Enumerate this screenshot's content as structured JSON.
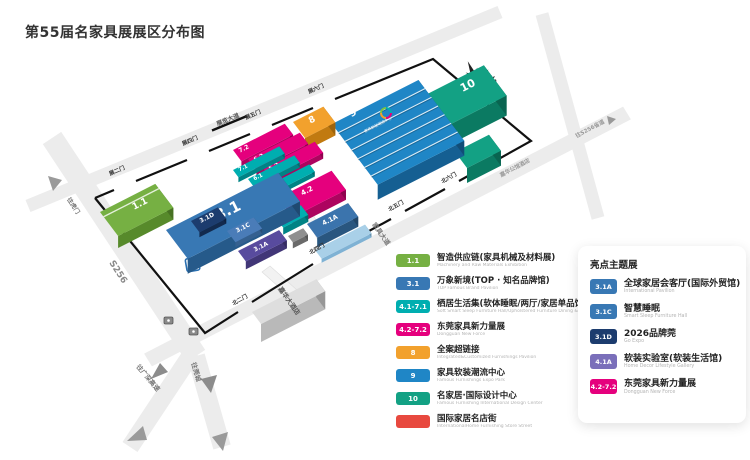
{
  "title": "第55届名家具展展区分布图",
  "legend": {
    "items": [
      {
        "badge": "1.1",
        "color": "#76b043",
        "title": "智造供应链(家具机械及材料展)",
        "subtitle": "Machinery and Raw Materials Exhibition"
      },
      {
        "badge": "3.1",
        "color": "#3878b4",
        "title": "万象新境(TOP · 知名品牌馆)",
        "subtitle": "TOP Famous Brand Pavilion"
      },
      {
        "badge": "4.1-7.1",
        "color": "#00aeb0",
        "title": "栖居生活集(软体睡眠/两厅/家居单品馆)",
        "subtitle": "Soft Smart Sleep Furniture Hall/Upholstered Furniture Dining & Living Furniture Hall"
      },
      {
        "badge": "4.2-7.2",
        "color": "#e5007d",
        "title": "东莞家具新力量展",
        "subtitle": "Dongguan New Force"
      },
      {
        "badge": "8",
        "color": "#f2a12d",
        "title": "全案超链接",
        "subtitle": "Integrated&Customized Furnishings Pavilion"
      },
      {
        "badge": "9",
        "color": "#1f86c6",
        "title": "家具软装潮流中心",
        "subtitle": "Famous Furnishings Expo Park"
      },
      {
        "badge": "10",
        "color": "#13a184",
        "title": "名家居·国际设计中心",
        "subtitle": "Famous Furnishing International Design Center"
      },
      {
        "badge": "",
        "color": "#e8493f",
        "title": "国际家居名店街",
        "subtitle": "InternationalHome Furnishing Store Street"
      }
    ]
  },
  "panel": {
    "header": "亮点主题展",
    "items": [
      {
        "badge": "3.1A",
        "color": "#3878b4",
        "title": "全球家居会客厅(国际外贸馆)",
        "subtitle": "International Pavilion"
      },
      {
        "badge": "3.1C",
        "color": "#3878b4",
        "title": "智慧睡眠",
        "subtitle": "Smart Sleep Furniture Hall"
      },
      {
        "badge": "3.1D",
        "color": "#1c3c6e",
        "title": "2026品牌莞",
        "subtitle": "Go Expo"
      },
      {
        "badge": "4.1A",
        "color": "#7a6fba",
        "title": "软装实验室(软装生活馆)",
        "subtitle": "Home Decor Lifestyle Gallery"
      },
      {
        "badge": "4.2-7.2",
        "color": "#e5007d",
        "title": "东莞家具新力量展",
        "subtitle": "Dongguan New Force"
      }
    ]
  },
  "map": {
    "compass_label": "北",
    "parking_label": "P",
    "halls": [
      {
        "id": "hall-10",
        "t": "10",
        "x": 392,
        "y": 112,
        "a": 103,
        "b": 38,
        "h": 20,
        "c": "#13a184",
        "s": "#0b7a62",
        "tx": 468,
        "ty": 86,
        "ts": 11
      },
      {
        "id": "hall-10-wing",
        "t": "",
        "x": 455,
        "y": 152,
        "a": 38,
        "b": 20,
        "h": 15,
        "c": "#13a184",
        "s": "#0b7a62"
      },
      {
        "id": "hall-9",
        "t": "9",
        "x": 332,
        "y": 124,
        "a": 97,
        "b": 76,
        "h": 15,
        "c": "#1f86c6",
        "s": "#155f92",
        "tx": 353,
        "ty": 113,
        "ts": 10,
        "stripes": 7,
        "sub": "家具软装潮流中心",
        "sx": 378,
        "sy": 125
      },
      {
        "id": "hall-8",
        "t": "8",
        "x": 293,
        "y": 122,
        "a": 34,
        "b": 20,
        "h": 13,
        "c": "#f2a12d",
        "s": "#c17a10",
        "tx": 312,
        "ty": 120,
        "ts": 9
      },
      {
        "id": "hall-7-2",
        "t": "7.2",
        "x": 233,
        "y": 150,
        "a": 58,
        "b": 14,
        "h": 6,
        "c": "#e5007d",
        "s": "#ad045f",
        "tx": 244,
        "ty": 149,
        "ts": 6
      },
      {
        "id": "hall-6-2",
        "t": "6.2",
        "x": 248,
        "y": 159,
        "a": 58,
        "b": 14,
        "h": 6,
        "c": "#e5007d",
        "s": "#ad045f",
        "tx": 259,
        "ty": 158,
        "ts": 6
      },
      {
        "id": "hall-5-2",
        "t": "5.2",
        "x": 263,
        "y": 168,
        "a": 58,
        "b": 14,
        "h": 6,
        "c": "#e5007d",
        "s": "#ad045f",
        "tx": 274,
        "ty": 167,
        "ts": 6
      },
      {
        "id": "hall-7-1",
        "t": "7.1",
        "x": 233,
        "y": 170,
        "a": 52,
        "b": 9,
        "h": 5,
        "c": "#00aeb0",
        "s": "#008385",
        "tx": 243,
        "ty": 168,
        "ts": 5.5
      },
      {
        "id": "hall-6-1",
        "t": "6.1",
        "x": 248,
        "y": 179,
        "a": 52,
        "b": 9,
        "h": 5,
        "c": "#00aeb0",
        "s": "#008385",
        "tx": 258,
        "ty": 177,
        "ts": 5.5
      },
      {
        "id": "hall-5-1",
        "t": "5.1",
        "x": 263,
        "y": 188,
        "a": 52,
        "b": 9,
        "h": 5,
        "c": "#00aeb0",
        "s": "#008385",
        "tx": 273,
        "ty": 186,
        "ts": 5.5
      },
      {
        "id": "hall-4-2",
        "t": "4.2",
        "x": 278,
        "y": 198,
        "a": 60,
        "b": 24,
        "h": 10,
        "c": "#e5007d",
        "s": "#ad045f",
        "tx": 307,
        "ty": 191,
        "ts": 7
      },
      {
        "id": "hall-4-1",
        "t": "4.1",
        "x": 276,
        "y": 218,
        "a": 28,
        "b": 12,
        "h": 7,
        "c": "#00aeb0",
        "s": "#008385",
        "tx": 288,
        "ty": 215,
        "ts": 5.5
      },
      {
        "id": "hall-4-1a",
        "t": "4.1A",
        "x": 307,
        "y": 224,
        "a": 46,
        "b": 17,
        "h": 10,
        "c": "#3b74ad",
        "s": "#29567f",
        "tx": 330,
        "ty": 220,
        "ts": 6.5
      },
      {
        "id": "hall-flat-slab",
        "t": "",
        "x": 315,
        "y": 250,
        "a": 56,
        "b": 11,
        "h": 4,
        "c": "#a9d0e8",
        "s": "#7fb2d4"
      },
      {
        "id": "hall-3-1",
        "t": "3.1",
        "x": 166,
        "y": 230,
        "a": 126,
        "b": 36,
        "h": 15,
        "c": "#3878b4",
        "s": "#265a8a",
        "tx": 228,
        "ty": 211,
        "ts": 15
      },
      {
        "id": "hall-3-1d",
        "t": "3.1D",
        "x": 191,
        "y": 221,
        "a": 30,
        "b": 14,
        "h": 5,
        "c": "#1c3c6e",
        "s": "#122a4e",
        "tx": 207,
        "ty": 218,
        "ts": 6
      },
      {
        "id": "hall-3-1c",
        "t": "3.1C",
        "x": 227,
        "y": 231,
        "a": 30,
        "b": 14,
        "h": 5,
        "c": "#4a7cb8",
        "s": "#35608f",
        "tx": 243,
        "ty": 228,
        "ts": 6
      },
      {
        "id": "hall-3-1a",
        "t": "3.1A",
        "x": 238,
        "y": 251,
        "a": 46,
        "b": 13,
        "h": 8,
        "c": "#584b9e",
        "s": "#413677",
        "tx": 261,
        "ty": 247,
        "ts": 6
      },
      {
        "id": "hall-1-1",
        "t": "1.1",
        "x": 100,
        "y": 212,
        "a": 62,
        "b": 30,
        "h": 12,
        "c": "#76b043",
        "s": "#578a2b",
        "tx": 140,
        "ty": 204,
        "ts": 9,
        "roofline": 6
      },
      {
        "id": "annex-box",
        "t": "",
        "x": 288,
        "y": 236,
        "a": 17,
        "b": 8,
        "h": 6,
        "c": "#8f8f8f",
        "s": "#6a6a6a"
      },
      {
        "id": "hotel-building",
        "t": "",
        "x": 252,
        "y": 312,
        "a": 72,
        "b": 15,
        "h": 18,
        "c": "#dedede",
        "s": "#b9b9b9"
      }
    ],
    "gates": [
      {
        "t": "展二门",
        "x": 117,
        "y": 171,
        "r": -23
      },
      {
        "t": "展四门",
        "x": 190,
        "y": 141,
        "r": -23
      },
      {
        "t": "展五门",
        "x": 253,
        "y": 115,
        "r": -23
      },
      {
        "t": "展六门",
        "x": 316,
        "y": 89,
        "r": -23
      },
      {
        "t": "北二门",
        "x": 240,
        "y": 300,
        "r": -29
      },
      {
        "t": "北四门",
        "x": 317,
        "y": 249,
        "r": -29
      },
      {
        "t": "北五门",
        "x": 396,
        "y": 206,
        "r": -29
      },
      {
        "t": "北六门",
        "x": 449,
        "y": 178,
        "r": -29
      }
    ],
    "road_labels": [
      {
        "t": "S256",
        "x": 118,
        "y": 272,
        "r": 57,
        "s": 9,
        "c": "#8a8a8a"
      },
      {
        "t": "往虎门",
        "x": 73,
        "y": 206,
        "r": 57,
        "s": 6,
        "c": "#777777"
      },
      {
        "t": "往广深高速",
        "x": 148,
        "y": 378,
        "r": 50,
        "s": 6.5,
        "c": "#777777"
      },
      {
        "t": "往莞城",
        "x": 196,
        "y": 372,
        "r": 74,
        "s": 6.5,
        "c": "#777777"
      },
      {
        "t": "展览大道",
        "x": 228,
        "y": 120,
        "r": -22.5,
        "s": 6,
        "c": "#555555"
      },
      {
        "t": "家具大道",
        "x": 381,
        "y": 234,
        "r": 55,
        "s": 6.5,
        "c": "#777777"
      },
      {
        "t": "嘉华大酒店",
        "x": 289,
        "y": 301,
        "r": 55,
        "s": 6.5,
        "c": "#555555"
      },
      {
        "t": "嘉华公馆酒店",
        "x": 515,
        "y": 168,
        "r": -28,
        "s": 5.5,
        "c": "#999999"
      },
      {
        "t": "往S256省道",
        "x": 590,
        "y": 129,
        "r": -28,
        "s": 5.5,
        "c": "#999999"
      }
    ]
  }
}
